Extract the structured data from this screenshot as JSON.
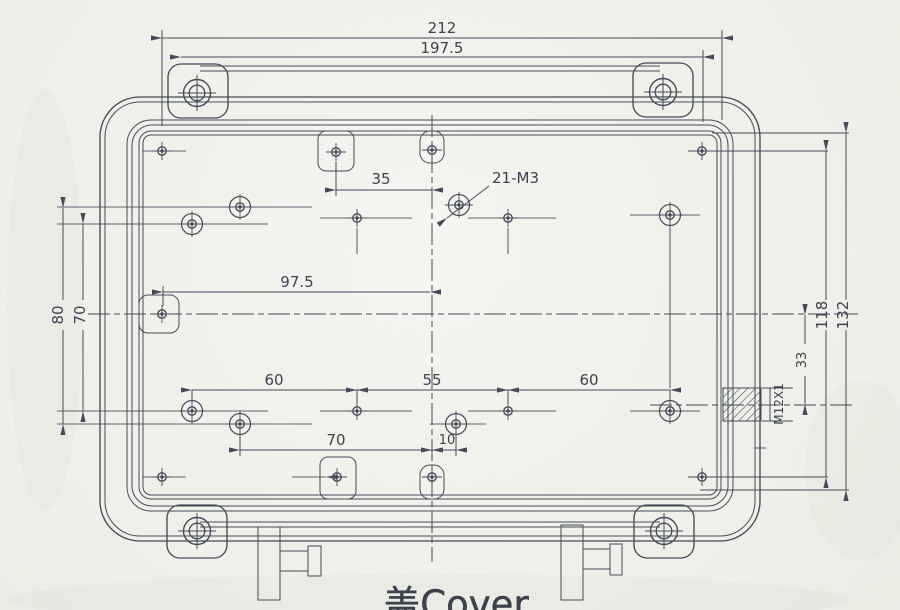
{
  "title": {
    "text": "盖Cover"
  },
  "annotations": {
    "holes_callout": "21-M3",
    "thread_label": "M12X1"
  },
  "dimensions": {
    "overall_width": "212",
    "screw_span_width": "197.5",
    "tab_to_center": "35",
    "tab_to_center_mid": "97.5",
    "left_col_outer": "80",
    "left_col_inner": "70",
    "row_seg_left": "60",
    "row_seg_center": "55",
    "row_seg_right": "60",
    "bottom_tab_offset": "70",
    "bottom_center_offset": "10",
    "corner_hole_span": "118",
    "floor_height": "132",
    "gland_offset": "33"
  },
  "colors": {
    "ink": "#454b57",
    "paper": "#f1f1ed"
  }
}
